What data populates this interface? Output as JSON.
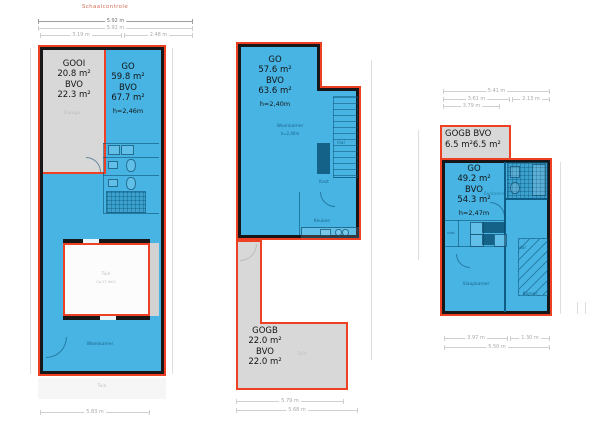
{
  "colors": {
    "blue": "#47b4e3",
    "gray": "#d8d8d8",
    "red_outline": "#ee4123",
    "wall": "#17171a",
    "accent_text": "#cf7058"
  },
  "scale_check": {
    "title": "Schaalcontrole",
    "total_a": "5.92 m",
    "total_b": "5.92 m",
    "seg_a": "3.19 m",
    "seg_b": "2.48 m"
  },
  "plan1": {
    "garage": {
      "title": "GOOI",
      "area": "20.8 m²",
      "bvo": "BVO",
      "bvo_value": "22.3 m²",
      "room": "Garage"
    },
    "main": {
      "title": "GO",
      "area": "59.8 m²",
      "bvo": "BVO",
      "bvo_value": "67.7 m²",
      "height": "h=2,46m"
    },
    "courtyard": {
      "room": "Tuin",
      "note": "Ca.17.3m2"
    },
    "living": "Woonkamer",
    "garden": "Tuin",
    "dim_bottom": "5.83 m"
  },
  "plan2": {
    "main": {
      "title": "GO",
      "area": "57.6 m²",
      "bvo": "BVO",
      "bvo_value": "63.6 m²",
      "height": "h=2,40m"
    },
    "rooms": {
      "living": "Woonkamer",
      "living_note": "h=2,40m",
      "hal": "Hal",
      "kast": "Kast",
      "keuken": "Keuken"
    },
    "outdoor": {
      "title": "GOGB",
      "area": "22.0 m²",
      "bvo": "BVO",
      "bvo_value": "22.0 m²",
      "room": "Tuin"
    },
    "dim_a": "5.79 m",
    "dim_b": "5.68 m"
  },
  "plan3": {
    "outdoor": {
      "label_a": "GOGB",
      "label_b": "BVO",
      "value_a": "6.5 m²",
      "value_b": "6.5 m²"
    },
    "main": {
      "title": "GO",
      "area": "49.2 m²",
      "bvo": "BVO",
      "bvo_value": "54.3 m²",
      "height": "h=2,47m"
    },
    "rooms": {
      "slaapkamer": "Slaapkamer",
      "hal": "Hal",
      "kamer": "Kamer",
      "kast": "Kast",
      "badkamer": "Badkamer"
    },
    "dims": {
      "top_total": "5.41 m",
      "top_a": "3.61 m",
      "top_b": "2.13 m",
      "top_c": "3.79 m",
      "bottom_a": "3.97 m",
      "bottom_b": "1.30 m",
      "bottom_total": "5.50 m"
    }
  }
}
